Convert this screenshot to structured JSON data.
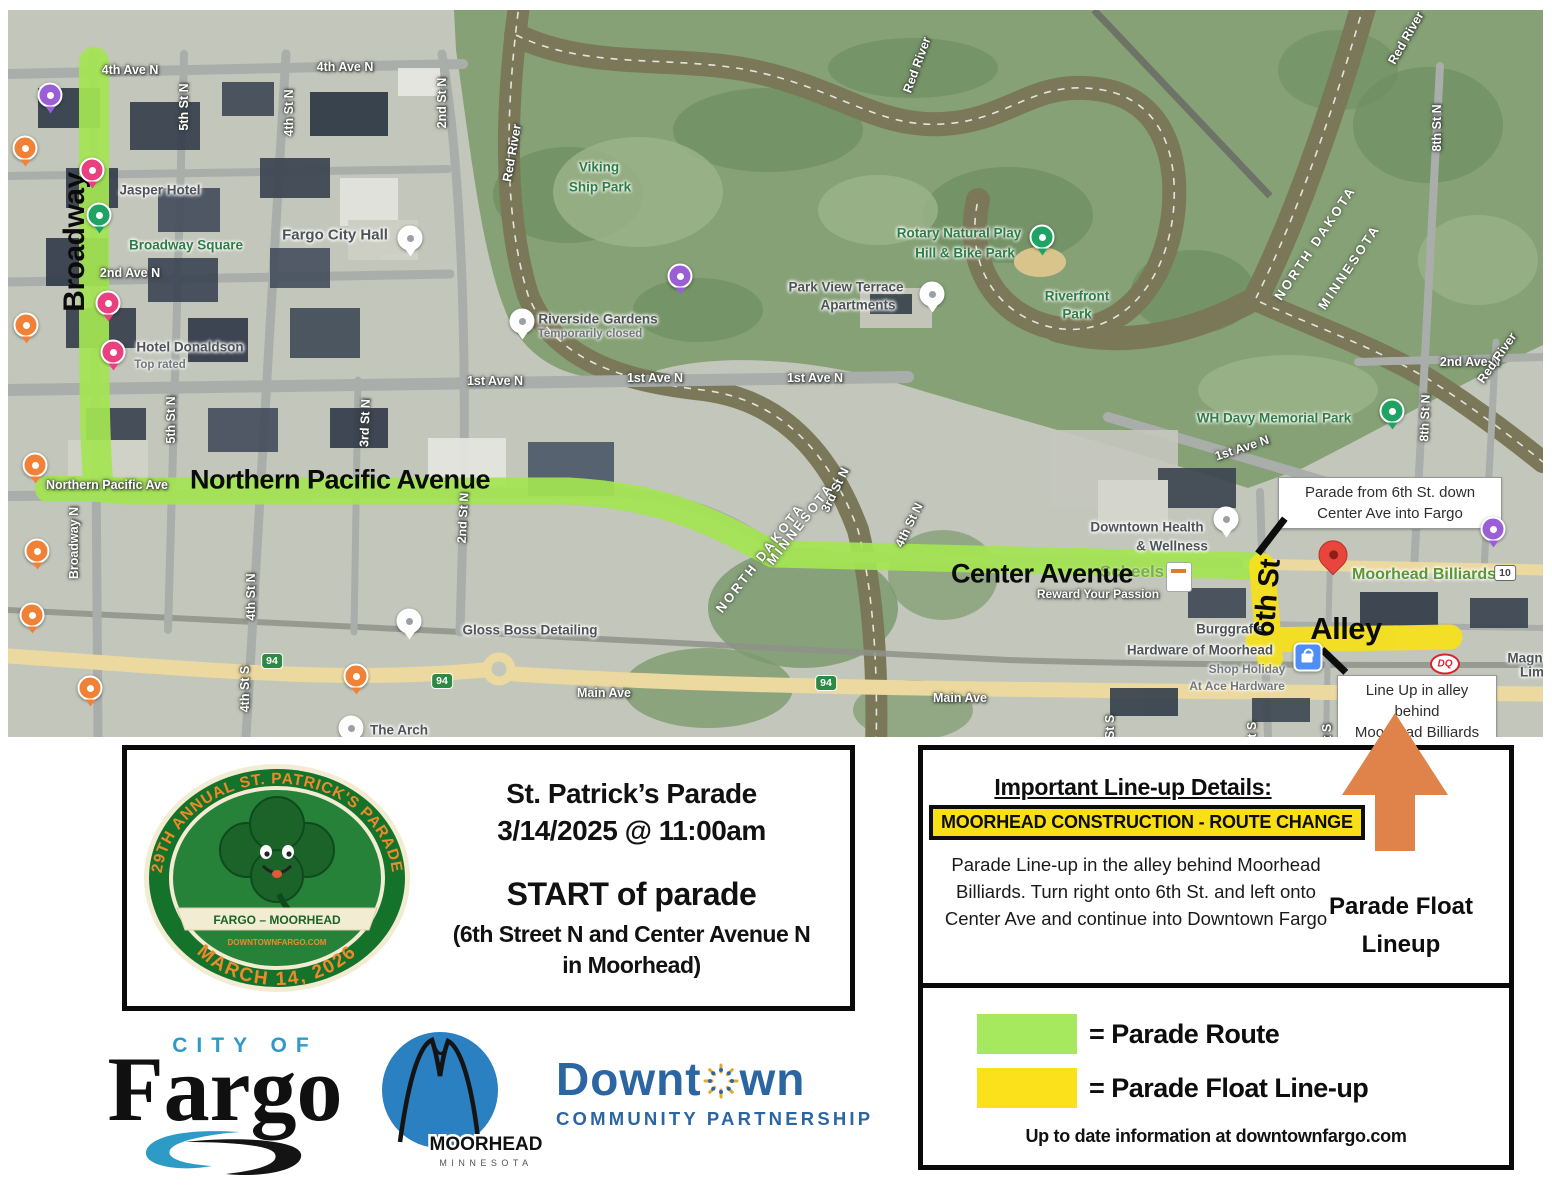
{
  "map": {
    "route_colors": {
      "parade_route": "#a4e553",
      "float_lineup": "#f5e11e"
    },
    "labels": [
      {
        "t": "4th Ave N",
        "x": 122,
        "y": 60,
        "c": "st"
      },
      {
        "t": "4th Ave N",
        "x": 337,
        "y": 57,
        "c": "st"
      },
      {
        "t": "2nd Ave N",
        "x": 122,
        "y": 263,
        "c": "st"
      },
      {
        "t": "2nd Ave N",
        "x": 1462,
        "y": 352,
        "c": "st"
      },
      {
        "t": "1st Ave N",
        "x": 487,
        "y": 371,
        "c": "st"
      },
      {
        "t": "1st Ave N",
        "x": 647,
        "y": 368,
        "c": "st"
      },
      {
        "t": "1st Ave N",
        "x": 807,
        "y": 368,
        "c": "st"
      },
      {
        "t": "1st Ave N",
        "x": 1234,
        "y": 438,
        "c": "st",
        "r": -18
      },
      {
        "t": "Main Ave",
        "x": 596,
        "y": 683,
        "c": "st"
      },
      {
        "t": "Main Ave",
        "x": 952,
        "y": 688,
        "c": "st"
      },
      {
        "t": "Northern Pacific Ave",
        "x": 99,
        "y": 475,
        "c": "st"
      },
      {
        "t": "5th St N",
        "x": 176,
        "y": 97,
        "c": "st",
        "r": -90
      },
      {
        "t": "4th St N",
        "x": 281,
        "y": 103,
        "c": "st",
        "r": -90
      },
      {
        "t": "2nd St N",
        "x": 434,
        "y": 93,
        "c": "st",
        "r": -90
      },
      {
        "t": "2nd St N",
        "x": 455,
        "y": 508,
        "c": "st",
        "r": -87
      },
      {
        "t": "8th St N",
        "x": 1429,
        "y": 118,
        "c": "st",
        "r": -90
      },
      {
        "t": "8th St N",
        "x": 1417,
        "y": 408,
        "c": "st",
        "r": -88
      },
      {
        "t": "Broadway N",
        "x": 66,
        "y": 533,
        "c": "st",
        "r": -90
      },
      {
        "t": "5th St N",
        "x": 163,
        "y": 410,
        "c": "st",
        "r": -90
      },
      {
        "t": "3rd St N",
        "x": 357,
        "y": 413,
        "c": "st",
        "r": -88
      },
      {
        "t": "4th St N",
        "x": 243,
        "y": 587,
        "c": "st",
        "r": -90
      },
      {
        "t": "4th St S",
        "x": 237,
        "y": 679,
        "c": "st",
        "r": -90
      },
      {
        "t": "3rd St N",
        "x": 827,
        "y": 480,
        "c": "st",
        "r": -64
      },
      {
        "t": "4th St N",
        "x": 901,
        "y": 515,
        "c": "st",
        "r": -64
      },
      {
        "t": "5th St S",
        "x": 1102,
        "y": 728,
        "c": "st",
        "r": -90
      },
      {
        "t": "6th St S",
        "x": 1244,
        "y": 735,
        "c": "st",
        "r": -90
      },
      {
        "t": "7th St S",
        "x": 1319,
        "y": 737,
        "c": "st",
        "r": -90
      },
      {
        "t": "Red River",
        "x": 504,
        "y": 143,
        "c": "st",
        "r": -80
      },
      {
        "t": "Red River",
        "x": 909,
        "y": 55,
        "c": "st",
        "r": -70
      },
      {
        "t": "Red River",
        "x": 1398,
        "y": 28,
        "c": "st",
        "r": -60
      },
      {
        "t": "Red River",
        "x": 1489,
        "y": 348,
        "c": "st",
        "r": -55
      },
      {
        "t": "Reward Your Passion",
        "x": 1090,
        "y": 584,
        "c": "st",
        "s": 12
      },
      {
        "t": "NORTH DAKOTA",
        "x": 752,
        "y": 548,
        "c": "state",
        "r": -52
      },
      {
        "t": "MINNESOTA",
        "x": 792,
        "y": 514,
        "c": "state",
        "r": -52
      },
      {
        "t": "NORTH DAKOTA",
        "x": 1307,
        "y": 233,
        "c": "state",
        "r": -56
      },
      {
        "t": "MINNESOTA",
        "x": 1341,
        "y": 257,
        "c": "state",
        "r": -56
      },
      {
        "t": "Jasper Hotel",
        "x": 152,
        "y": 180,
        "c": "poi"
      },
      {
        "t": "Fargo City Hall",
        "x": 327,
        "y": 225,
        "c": "poi",
        "s": 15
      },
      {
        "t": "Hotel Donaldson",
        "x": 182,
        "y": 337,
        "c": "poi"
      },
      {
        "t": "Top rated",
        "x": 152,
        "y": 355,
        "c": "poi-sub"
      },
      {
        "t": "Riverside Gardens",
        "x": 590,
        "y": 309,
        "c": "poi"
      },
      {
        "t": "Temporarily closed",
        "x": 582,
        "y": 324,
        "c": "poi-sub"
      },
      {
        "t": "Park View Terrace",
        "x": 838,
        "y": 277,
        "c": "poi"
      },
      {
        "t": "Apartments",
        "x": 850,
        "y": 295,
        "c": "poi"
      },
      {
        "t": "Downtown Health",
        "x": 1139,
        "y": 517,
        "c": "poi"
      },
      {
        "t": "& Wellness",
        "x": 1164,
        "y": 536,
        "c": "poi"
      },
      {
        "t": "Gloss Boss Detailing",
        "x": 522,
        "y": 620,
        "c": "poi"
      },
      {
        "t": "The Arch",
        "x": 391,
        "y": 720,
        "c": "poi"
      },
      {
        "t": "Burggraf's",
        "x": 1222,
        "y": 619,
        "c": "poi"
      },
      {
        "t": "Hardware of Moorhead",
        "x": 1192,
        "y": 640,
        "c": "poi"
      },
      {
        "t": "Shop Holiday",
        "x": 1239,
        "y": 659,
        "c": "poi-sub",
        "s": 12
      },
      {
        "t": "At Ace Hardware",
        "x": 1229,
        "y": 676,
        "c": "poi-sub",
        "s": 12
      },
      {
        "t": "Browse Our",
        "x": 1438,
        "y": 716,
        "c": "poi"
      },
      {
        "t": "Magn",
        "x": 1517,
        "y": 648,
        "c": "poi"
      },
      {
        "t": "Lim",
        "x": 1524,
        "y": 662,
        "c": "poi"
      },
      {
        "t": "Broadway Square",
        "x": 178,
        "y": 235,
        "c": "pg"
      },
      {
        "t": "Viking",
        "x": 591,
        "y": 157,
        "c": "pg"
      },
      {
        "t": "Ship Park",
        "x": 592,
        "y": 177,
        "c": "pg"
      },
      {
        "t": "Rotary Natural Play",
        "x": 951,
        "y": 223,
        "c": "pg"
      },
      {
        "t": "Hill & Bike Park",
        "x": 957,
        "y": 243,
        "c": "pg"
      },
      {
        "t": "Riverfront",
        "x": 1069,
        "y": 286,
        "c": "pg"
      },
      {
        "t": "Park",
        "x": 1069,
        "y": 304,
        "c": "pg"
      },
      {
        "t": "WH Davy Memorial Park",
        "x": 1266,
        "y": 408,
        "c": "pg"
      },
      {
        "t": "Moorhead Billiards",
        "x": 1416,
        "y": 565,
        "c": "pg-big"
      },
      {
        "t": "Scheels",
        "x": 1124,
        "y": 562,
        "c": "pg-faded"
      },
      {
        "t": "Broadway",
        "x": 67,
        "y": 232,
        "c": "rt",
        "r": -90,
        "s": 30
      },
      {
        "t": "Northern Pacific Avenue",
        "x": 332,
        "y": 470,
        "c": "rt",
        "s": 27
      },
      {
        "t": "Center Avenue",
        "x": 1034,
        "y": 564,
        "c": "rt",
        "s": 27
      },
      {
        "t": "6th St",
        "x": 1260,
        "y": 588,
        "c": "rt",
        "r": -85,
        "s": 29
      },
      {
        "t": "Alley",
        "x": 1338,
        "y": 619,
        "c": "rt",
        "s": 31
      }
    ],
    "pins": [
      {
        "k": "pindrop pk-orange",
        "n": "restaurant-pin",
        "x": 17,
        "y": 138
      },
      {
        "k": "pindrop pk-orange",
        "n": "restaurant-pin",
        "x": 18,
        "y": 315
      },
      {
        "k": "pindrop pk-orange",
        "n": "restaurant-pin",
        "x": 27,
        "y": 455
      },
      {
        "k": "pindrop pk-orange",
        "n": "restaurant-pin",
        "x": 29,
        "y": 541
      },
      {
        "k": "pindrop pk-orange",
        "n": "restaurant-pin",
        "x": 24,
        "y": 605
      },
      {
        "k": "pindrop pk-orange",
        "n": "restaurant-pin",
        "x": 82,
        "y": 678
      },
      {
        "k": "pindrop pk-orange",
        "n": "restaurant-pin",
        "x": 348,
        "y": 666
      },
      {
        "k": "pindrop pk-pink",
        "n": "hotel-pin",
        "x": 84,
        "y": 160
      },
      {
        "k": "pindrop pk-pink",
        "n": "hotel-pin",
        "x": 100,
        "y": 293
      },
      {
        "k": "pindrop pk-pink",
        "n": "hotel-pin",
        "x": 105,
        "y": 342
      },
      {
        "k": "pindrop pk-purple",
        "n": "museum-pin",
        "x": 42,
        "y": 85
      },
      {
        "k": "pindrop pk-purple",
        "n": "museum-pin",
        "x": 672,
        "y": 266
      },
      {
        "k": "pindrop pk-purple",
        "n": "museum-pin",
        "x": 1485,
        "y": 519
      },
      {
        "k": "pindrop pk-green",
        "n": "park-pin",
        "x": 91,
        "y": 205
      },
      {
        "k": "pindrop pk-green",
        "n": "park-pin",
        "x": 1034,
        "y": 227
      },
      {
        "k": "pindrop pk-green",
        "n": "park-pin",
        "x": 1384,
        "y": 401
      },
      {
        "k": "pindrop pk-white",
        "n": "poi-pin",
        "x": 402,
        "y": 228
      },
      {
        "k": "pindrop pk-white",
        "n": "poi-pin",
        "x": 514,
        "y": 311
      },
      {
        "k": "pindrop pk-white",
        "n": "poi-pin",
        "x": 924,
        "y": 284
      },
      {
        "k": "pindrop pk-white",
        "n": "poi-pin",
        "x": 1218,
        "y": 509
      },
      {
        "k": "pindrop pk-white",
        "n": "poi-pin",
        "x": 401,
        "y": 611
      },
      {
        "k": "pindrop pk-white",
        "n": "poi-pin",
        "x": 343,
        "y": 718
      },
      {
        "k": "pin-red",
        "n": "destination-pin-moorhead-billiards",
        "x": 1325,
        "y": 557
      },
      {
        "k": "pin-shop",
        "n": "shopping-pin",
        "x": 1300,
        "y": 647
      },
      {
        "k": "pin-dq",
        "n": "dairy-queen-logo-pin",
        "x": 1437,
        "y": 654,
        "t": "DQ"
      },
      {
        "k": "pin-scheels",
        "n": "scheels-store-marker",
        "x": 1171,
        "y": 567
      },
      {
        "k": "sh94",
        "n": "interstate-94-shield",
        "x": 264,
        "y": 651,
        "t": "94"
      },
      {
        "k": "sh94",
        "n": "interstate-94-shield",
        "x": 434,
        "y": 671,
        "t": "94"
      },
      {
        "k": "sh94",
        "n": "interstate-94-shield",
        "x": 818,
        "y": 673,
        "t": "94"
      },
      {
        "k": "sh10",
        "n": "highway-10-shield",
        "x": 1497,
        "y": 563,
        "t": "10"
      }
    ],
    "callouts": [
      {
        "x": 1270,
        "y": 467,
        "w": 212,
        "lines": [
          "Parade from 6th St. down",
          "Center Ave into Fargo"
        ]
      },
      {
        "x": 1329,
        "y": 665,
        "w": 148,
        "lines": [
          "Line Up in alley behind",
          "Moorhead Billiards"
        ]
      }
    ],
    "connectors": [
      {
        "x": 1250,
        "y": 543,
        "len": 44,
        "ang": -52.4
      },
      {
        "x": 1314,
        "y": 639,
        "len": 33,
        "ang": 43.8
      }
    ]
  },
  "info_box": {
    "title_line1": "St. Patrick’s Parade",
    "title_line2": "3/14/2025 @ 11:00am",
    "start_line": "START of parade",
    "location_line1": "(6th Street N and Center Avenue N",
    "location_line2": "in Moorhead)"
  },
  "logo_seal": {
    "top_text": "29TH ANNUAL  ST. PATRICK'S PARADE",
    "ribbon": "FARGO – MOORHEAD",
    "site": "DOWNTOWNFARGO.COM",
    "bottom_text": "MARCH 14, 2026"
  },
  "lineup_box": {
    "title": "Important Line-up Details:",
    "badge": "MOORHEAD CONSTRUCTION - ROUTE CHANGE",
    "body": "Parade Line-up in the alley behind Moorhead Billiards. Turn right onto 6th St. and left onto Center Ave and continue into Downtown Fargo",
    "arrow_label_line1": "Parade Float",
    "arrow_label_line2": "Lineup"
  },
  "legend_box": {
    "items": [
      {
        "color": "#a6e85e",
        "label": "= Parade Route"
      },
      {
        "color": "#fbe11c",
        "label": "= Parade Float Line-up"
      }
    ],
    "footer": "Up to date information at downtownfargo.com"
  },
  "logos": {
    "fargo": {
      "city_of": "CITY OF",
      "name": "Fargo"
    },
    "moorhead": {
      "name": "MOORHEAD",
      "state": "MINNESOTA"
    },
    "dcp": {
      "part1": "Downt",
      "part2": "wn",
      "subtitle": "COMMUNITY PARTNERSHIP"
    }
  }
}
